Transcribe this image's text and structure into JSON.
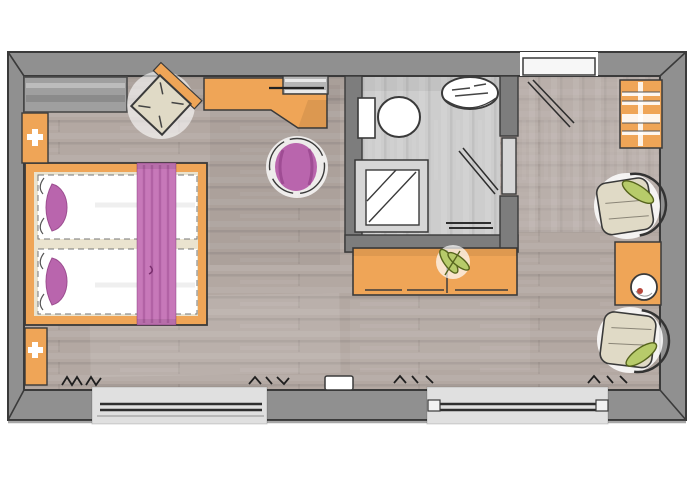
{
  "plan": {
    "type": "floor-plan",
    "rooms": [
      "bedroom",
      "bathroom",
      "entry"
    ],
    "items": [
      "double-bed",
      "bed-runner",
      "bed-pillows",
      "nightstand-top",
      "nightstand-bottom",
      "wardrobe",
      "corner-armchair",
      "desk",
      "tv",
      "desk-stool",
      "toilet",
      "sink",
      "shower",
      "bathroom-door",
      "entrance-door",
      "luggage-rack",
      "armchair-top",
      "armchair-bottom",
      "side-table",
      "cup",
      "sideboard",
      "plant",
      "window-left",
      "window-right",
      "curtain-marks",
      "floor-box"
    ]
  },
  "colors": {
    "bg": "#ffffff",
    "wall": "#909090",
    "wall_bath": "#7d7d7d",
    "outline": "#3a3a3a",
    "floor": "#b3a8a2",
    "floor_entry": "#c2b9b3",
    "floor_bath": "#cdcdcd",
    "window": "#e0e0e0",
    "door_leaf": "#f7f7f7",
    "bath_door": "#d6d6d6",
    "orange": "#efa557",
    "purple": "#b965ad",
    "runner": "#c778b9",
    "beige": "#e0dac6",
    "green": "#b7cb6a",
    "wardrobe": "#9f9f9f",
    "tv": "#b6b6b6",
    "white": "#ffffff",
    "shower_tray": "#d6d6d6",
    "cup_accent": "#b8473c"
  }
}
